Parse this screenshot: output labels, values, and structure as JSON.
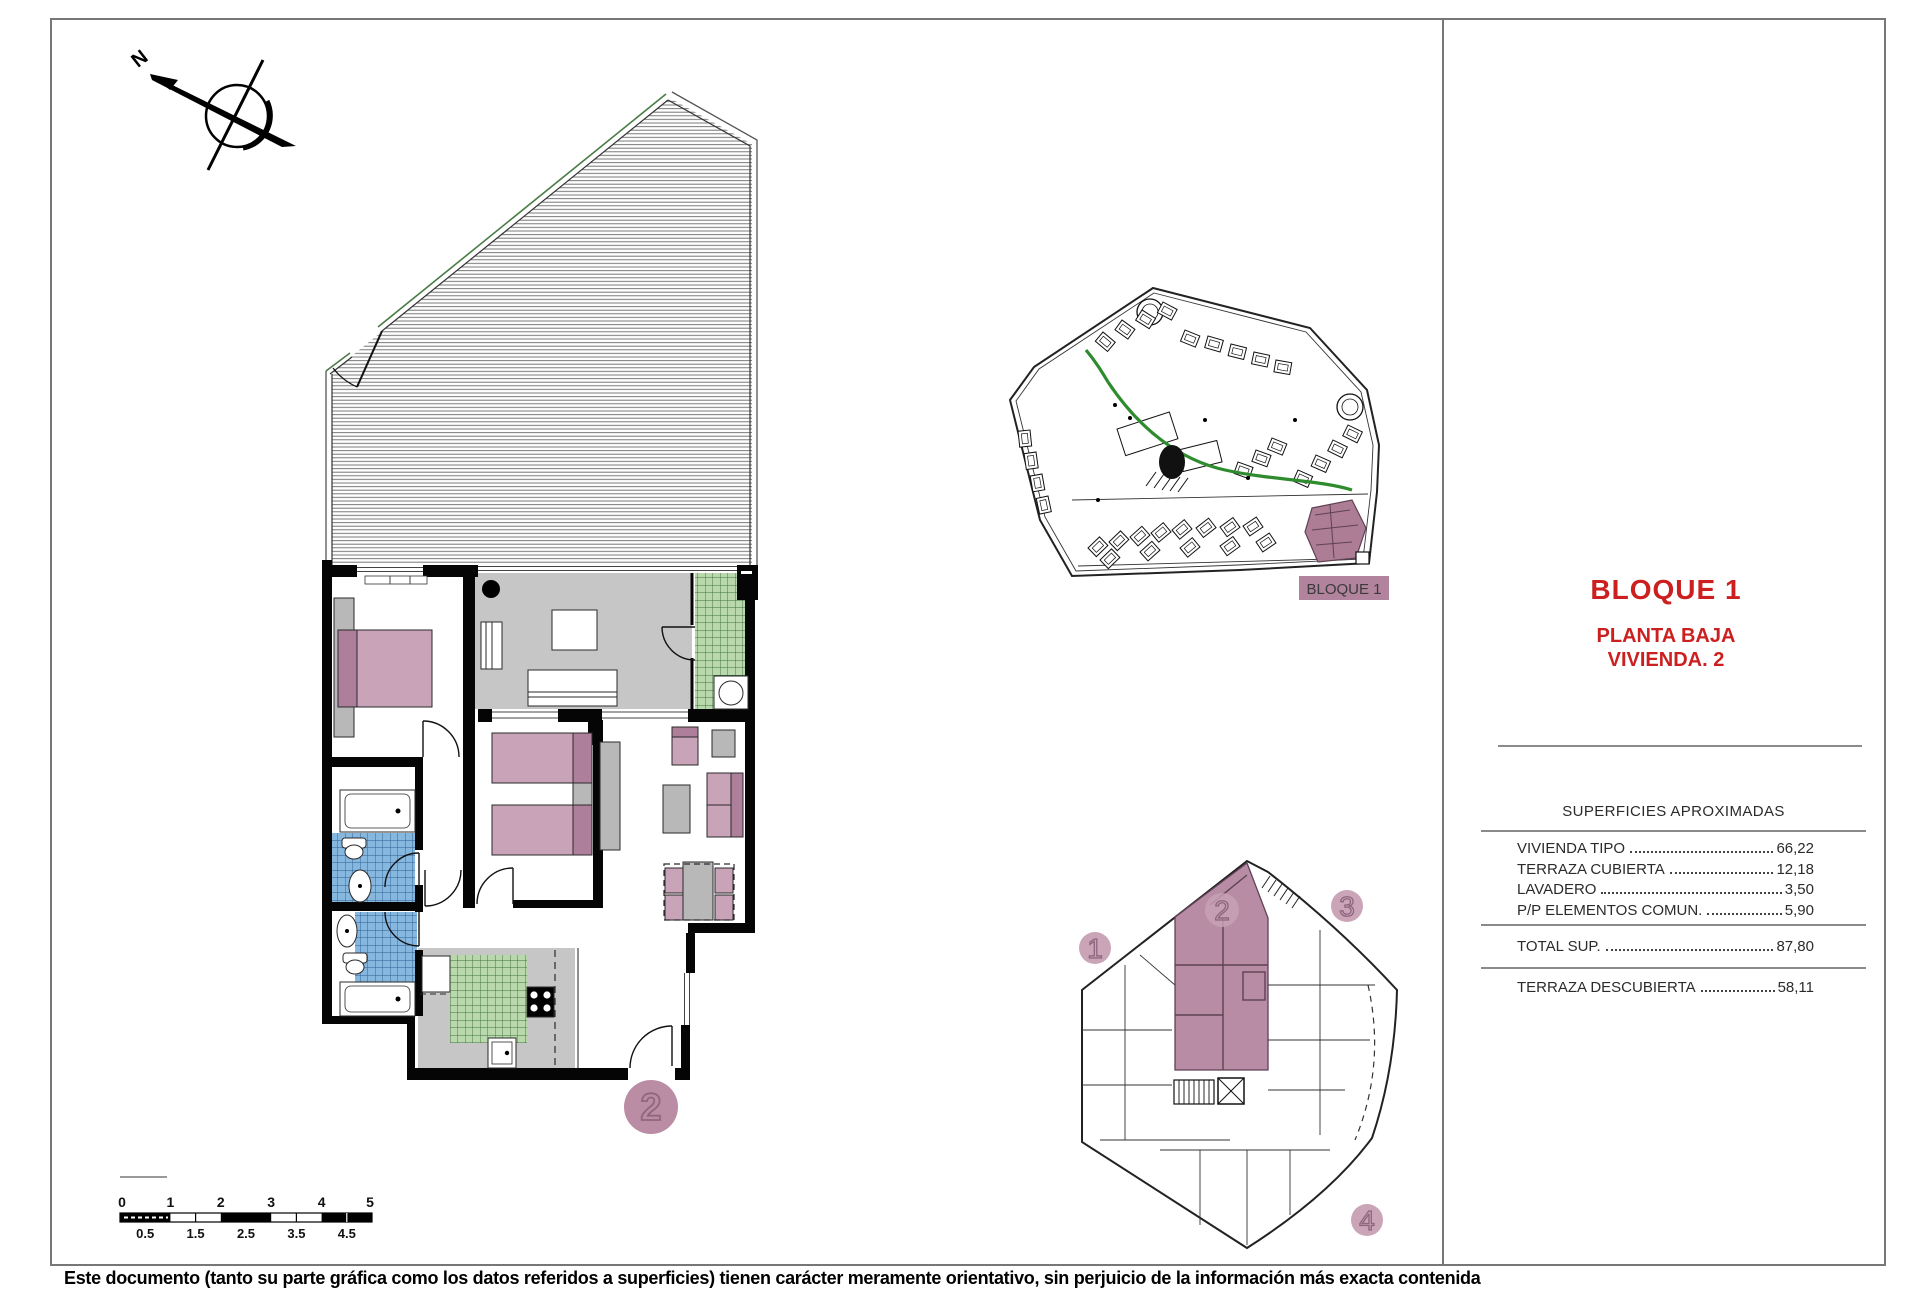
{
  "panel": {
    "block_title": "BLOQUE 1",
    "floor_line1": "PLANTA BAJA",
    "floor_line2": "VIVIENDA. 2",
    "table_title": "SUPERFICIES APROXIMADAS",
    "rows": [
      {
        "label": "VIVIENDA TIPO",
        "value": "66,22"
      },
      {
        "label": "TERRAZA CUBIERTA",
        "value": "12,18"
      },
      {
        "label": "LAVADERO",
        "value": "3,50"
      },
      {
        "label": "P/P ELEMENTOS COMUN.",
        "value": "5,90"
      }
    ],
    "total": {
      "label": "TOTAL SUP.",
      "value": "87,80"
    },
    "terrace": {
      "label": "TERRAZA DESCUBIERTA",
      "value": "58,11"
    }
  },
  "floor_plan": {
    "unit_label": "2"
  },
  "site_plan": {
    "label": "BLOQUE 1"
  },
  "key_plan": {
    "units": [
      "1",
      "2",
      "3",
      "4"
    ]
  },
  "compass": {
    "label": "N"
  },
  "scale_bar": {
    "top": [
      "0",
      "1",
      "2",
      "3",
      "4",
      "5"
    ],
    "bottom": [
      "0.5",
      "1.5",
      "2.5",
      "3.5",
      "4.5"
    ]
  },
  "page": {
    "disclaimer": "Este documento (tanto su parte gráfica como los datos referidos a superficies) tienen carácter meramente orientativo, sin perjuicio de la información más exacta contenida"
  },
  "colors": {
    "accent_red": "#cc2020",
    "highlight_mauve": "#b2839c",
    "furniture_pink": "#c9a3b8",
    "tile_green": "#b9d8ab",
    "tile_blue": "#86b7df",
    "floor_gray": "#c6c6c6",
    "path_green": "#2e8b2e"
  }
}
